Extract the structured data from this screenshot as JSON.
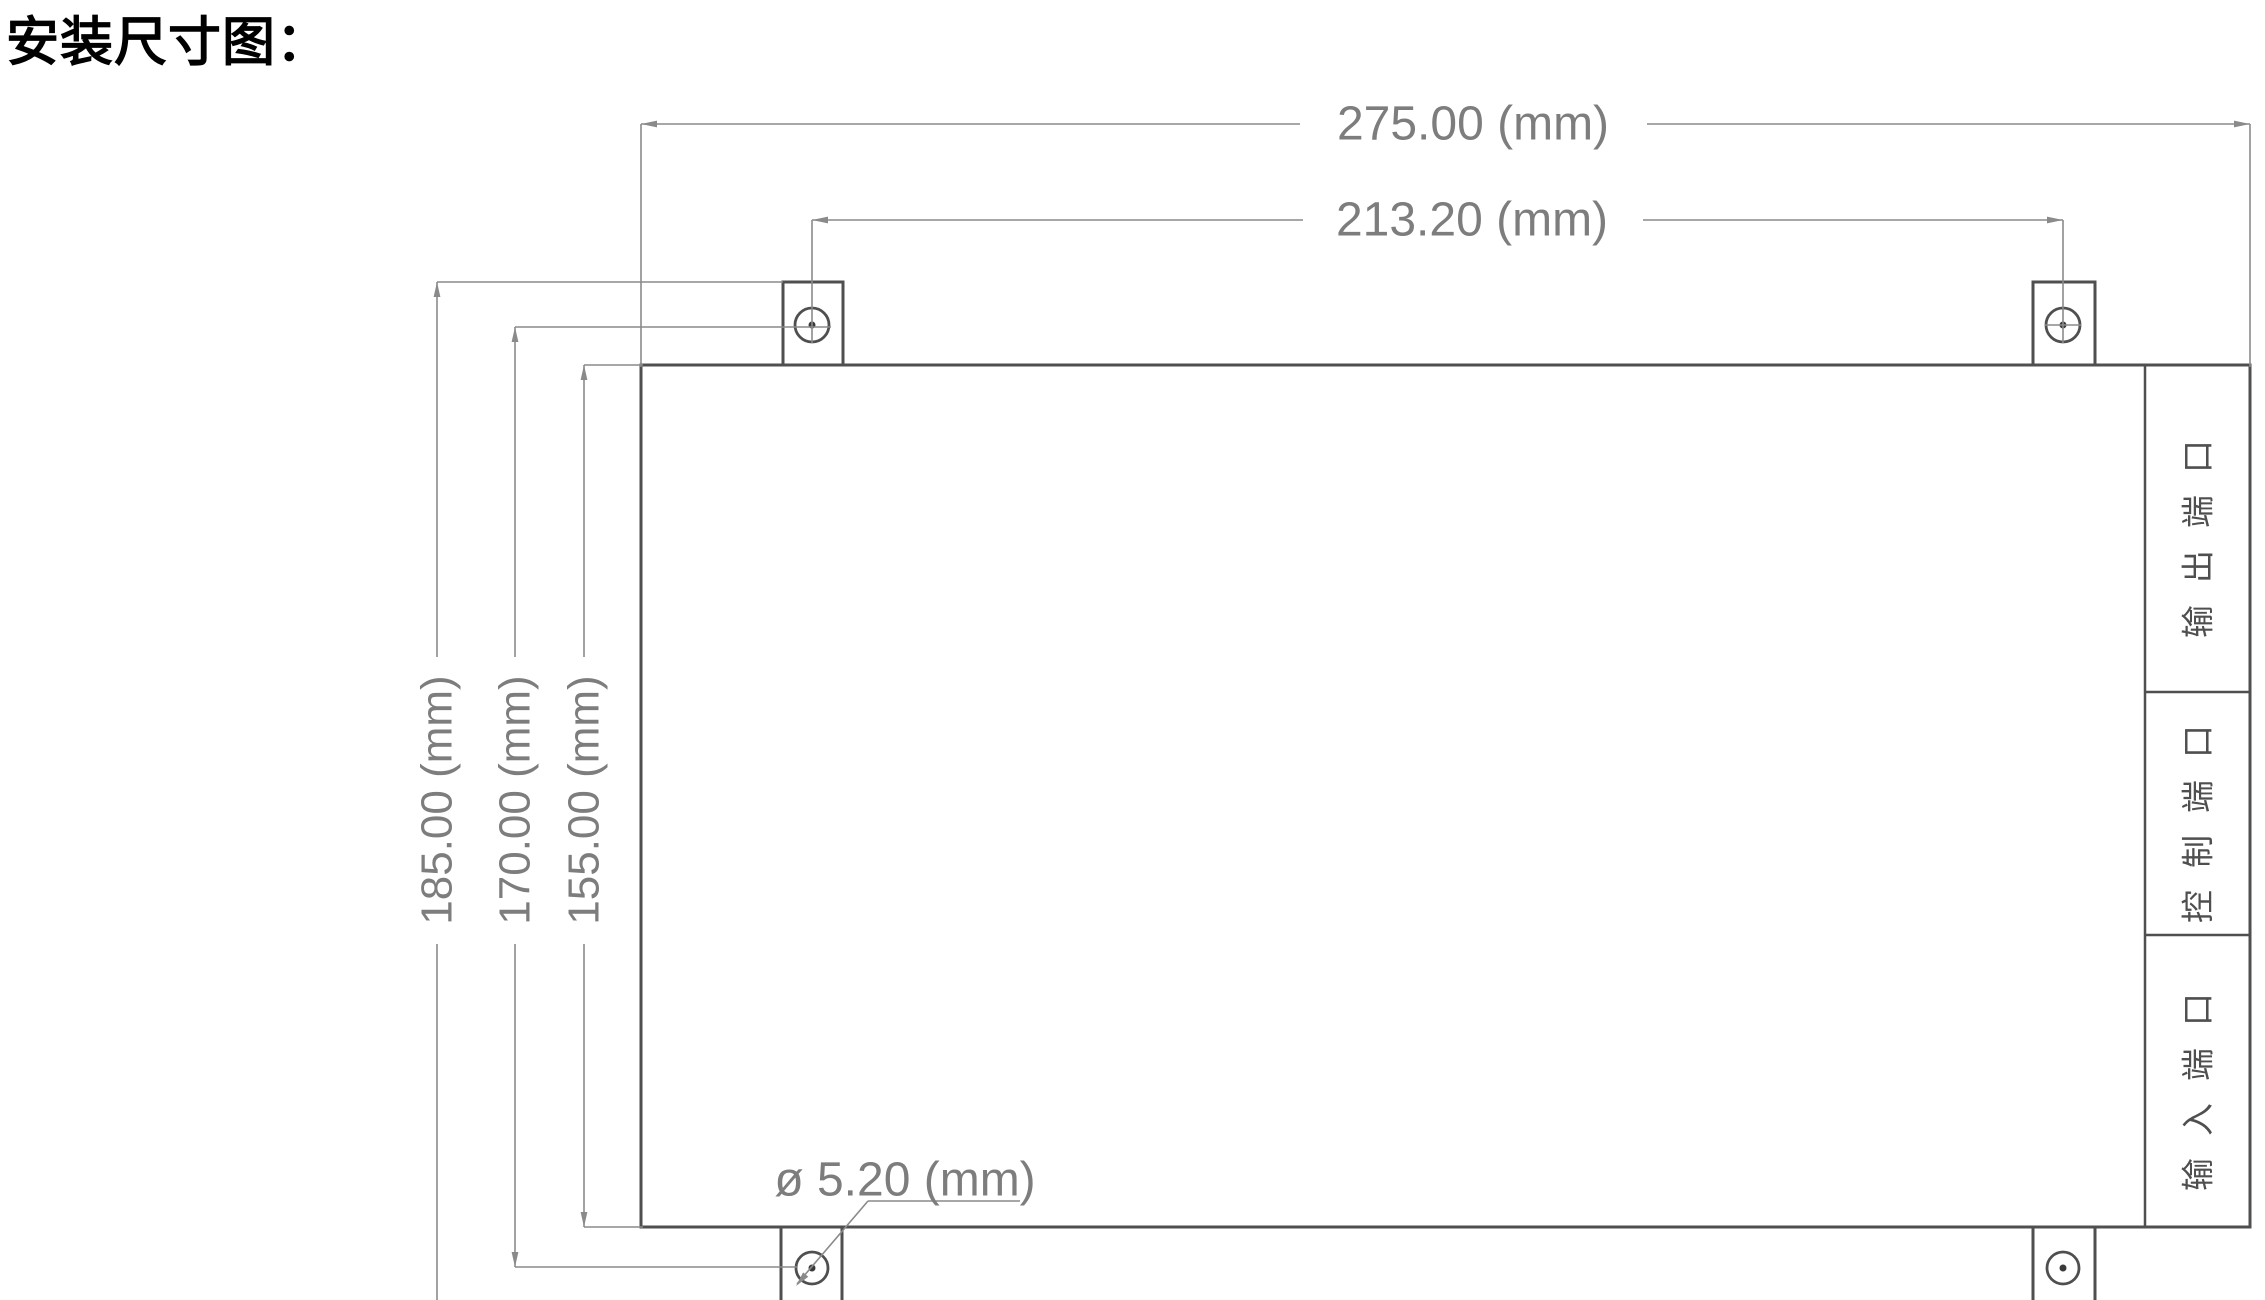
{
  "title": "安装尺寸图：",
  "drawing": {
    "dims": {
      "outer_width": "275.00 (mm)",
      "hole_span_width": "213.20 (mm)",
      "outer_height": "185.00 (mm)",
      "hole_span_height": "170.00 (mm)",
      "body_height": "155.00 (mm)",
      "hole_diameter": "ø 5.20 (mm)"
    },
    "ports": [
      {
        "label": "输出端口"
      },
      {
        "label": "控制端口"
      },
      {
        "label": "输入端口"
      }
    ],
    "colors": {
      "outline": "#4f4f4f",
      "dimension_line": "#8a8a8a",
      "dimension_text": "#7d7d7d",
      "port_text": "#4f4f4f",
      "title_text": "#000000",
      "background": "#ffffff"
    }
  }
}
